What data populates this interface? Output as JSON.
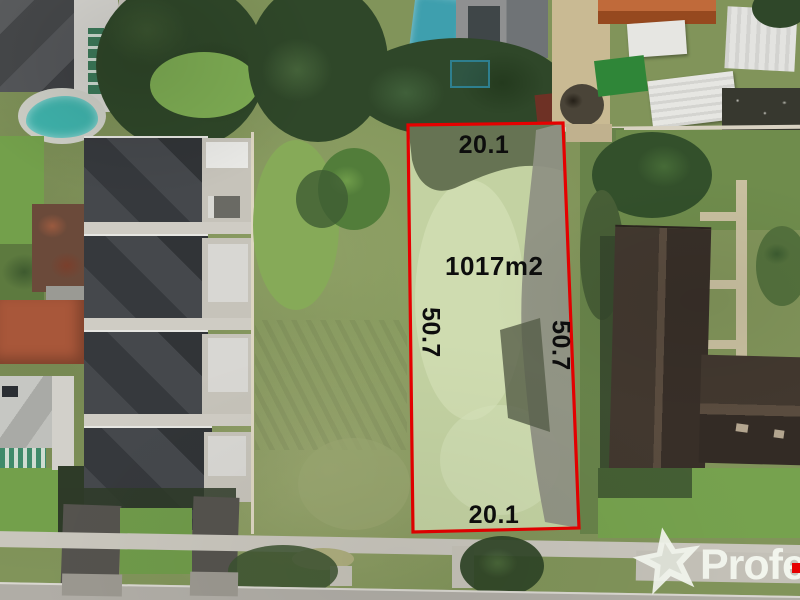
{
  "annotation": {
    "area": "1017m2",
    "frontage_top": "20.1",
    "frontage_bottom": "20.1",
    "side_left": "50.7",
    "side_right": "50.7"
  },
  "watermark": {
    "text": "Profes",
    "star_icon": "professionals-star"
  },
  "palette": {
    "boundary": "#e60000",
    "labelInk": "#0d0d0d",
    "wmColor": "#f5f8f0",
    "field": "#81945a",
    "lotFill": "#c3d2a2",
    "lotPale": "#d8e3bb",
    "lotShadow": "#5c684a",
    "lotBand": "#8f9184",
    "roofDark": "#3c3f42",
    "brownRoof": "#42382f",
    "brownRidge": "#5a4c3f",
    "concrete": "#c6c3ba",
    "road": "#b0ada6",
    "path": "#c9c6bd",
    "verge": "#7b9a50",
    "lawn": "#73a04b",
    "treeDark": "#2f4729",
    "treeMid": "#4c6b38",
    "poolTeal": "#3fb3ac",
    "poolBlue": "#3e9fae",
    "orangeRoof": "#b05c30",
    "terracotta": "#a8573a",
    "shedWhite": "#e6e6e2",
    "paleGround": "#c9ba93",
    "rubble": "#37382f",
    "shadow": "#2e3b28",
    "turfGreen": "#2f8638"
  }
}
